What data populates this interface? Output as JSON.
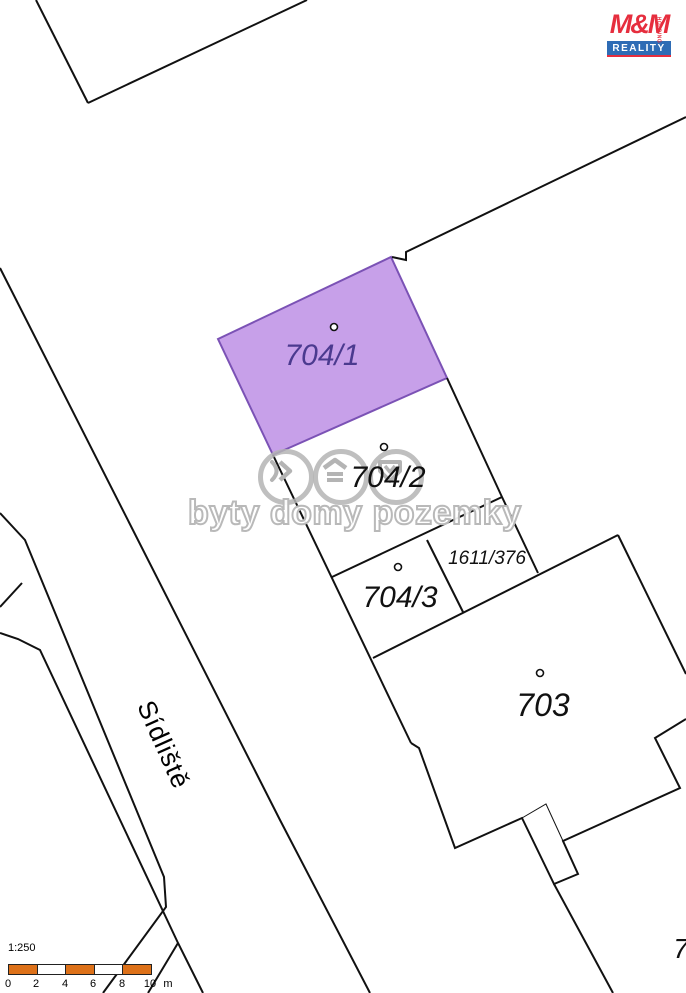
{
  "street": {
    "name": "Sídliště"
  },
  "logo": {
    "brand": "M&M",
    "sub": "REALITY",
    "side": "HOLDING"
  },
  "watermark": {
    "text": "byty domy pozemky",
    "icons": [
      "chevrons-icon",
      "roof-icon",
      "house-shield-icon"
    ]
  },
  "scale_bar": {
    "ratio": "1:250",
    "ticks": [
      "0",
      "2",
      "4",
      "6",
      "8",
      "10"
    ],
    "unit": "m"
  },
  "colors": {
    "line": "#111111",
    "highlight_fill": "#c7a0e9",
    "highlight_stroke": "#7b52b5",
    "highlight_label": "#4b3a8f",
    "watermark_gray": "#b9b9b9",
    "scale_orange": "#dd7119",
    "logo_red": "#e62e3e",
    "logo_blue": "#2e6cb5"
  },
  "map": {
    "width": 686,
    "height": 993,
    "highlight_parcel": {
      "name": "parcel-704-1",
      "label": "704/1",
      "points": [
        [
          218,
          339
        ],
        [
          391,
          257
        ],
        [
          447,
          378
        ],
        [
          273,
          455
        ]
      ]
    },
    "lines": [
      {
        "name": "nw-building-edge-left",
        "pts": [
          [
            36,
            0
          ],
          [
            88,
            103
          ]
        ]
      },
      {
        "name": "nw-building-edge-right",
        "pts": [
          [
            88,
            103
          ],
          [
            307,
            0
          ]
        ]
      },
      {
        "name": "ne-boundary-line",
        "pts": [
          [
            392,
            257
          ],
          [
            406,
            260
          ],
          [
            406,
            252
          ],
          [
            686,
            117
          ]
        ]
      },
      {
        "name": "street-east-edge",
        "pts": [
          [
            0,
            268
          ],
          [
            280,
            820
          ],
          [
            370,
            993
          ]
        ]
      },
      {
        "name": "street-west-edge",
        "pts": [
          [
            0,
            513
          ],
          [
            25,
            540
          ],
          [
            164,
            877
          ],
          [
            166,
            907
          ],
          [
            103,
            993
          ]
        ]
      },
      {
        "name": "sidewalk-edge",
        "pts": [
          [
            0,
            633
          ],
          [
            18,
            639
          ],
          [
            40,
            650
          ],
          [
            178,
            943
          ],
          [
            203,
            993
          ]
        ]
      },
      {
        "name": "sidewalk-spur",
        "pts": [
          [
            148,
            993
          ],
          [
            178,
            943
          ]
        ]
      },
      {
        "name": "west-edge-fragment",
        "pts": [
          [
            22,
            583
          ],
          [
            0,
            607
          ]
        ]
      },
      {
        "name": "parcel-street-boundary",
        "pts": [
          [
            273,
            455
          ],
          [
            411,
            743
          ]
        ]
      },
      {
        "name": "parcel-704-2-east-boundary",
        "pts": [
          [
            447,
            378
          ],
          [
            502,
            497
          ],
          [
            538,
            573
          ]
        ]
      },
      {
        "name": "parcel-704-2-704-3-boundary",
        "pts": [
          [
            502,
            497
          ],
          [
            332,
            577
          ]
        ]
      },
      {
        "name": "parcel-1611-376-west-boundary",
        "pts": [
          [
            427,
            540
          ],
          [
            463,
            612
          ]
        ]
      },
      {
        "name": "building-703-top-left-edge",
        "pts": [
          [
            373,
            658
          ],
          [
            618,
            535
          ]
        ]
      },
      {
        "name": "building-703-top-right-edge",
        "pts": [
          [
            618,
            535
          ],
          [
            686,
            674
          ]
        ]
      },
      {
        "name": "building-703-outline",
        "pts": [
          [
            686,
            719
          ],
          [
            655,
            738
          ],
          [
            680,
            788
          ],
          [
            563,
            841
          ],
          [
            578,
            874
          ],
          [
            554,
            884
          ],
          [
            522,
            818
          ],
          [
            455,
            848
          ],
          [
            419,
            748
          ],
          [
            411,
            743
          ]
        ]
      },
      {
        "name": "building-703-annex-thin-edge",
        "pts": [
          [
            522,
            818
          ],
          [
            546,
            804
          ],
          [
            563,
            841
          ]
        ],
        "w": 1
      },
      {
        "name": "south-parcel-boundary",
        "pts": [
          [
            554,
            884
          ],
          [
            613,
            993
          ]
        ]
      }
    ],
    "markers": [
      {
        "name": "parcel-point-704-1",
        "x": 334,
        "y": 327
      },
      {
        "name": "parcel-point-704-2",
        "x": 384,
        "y": 447
      },
      {
        "name": "parcel-point-704-3",
        "x": 398,
        "y": 567
      },
      {
        "name": "parcel-point-703",
        "x": 540,
        "y": 673
      }
    ],
    "labels": [
      {
        "name": "parcel-label-704-1",
        "text": "704/1",
        "x": 322,
        "y": 365,
        "size": 30,
        "color": "#4b3a8f"
      },
      {
        "name": "parcel-label-704-2",
        "text": "704/2",
        "x": 388,
        "y": 487,
        "size": 30,
        "color": "#111111"
      },
      {
        "name": "parcel-label-704-3",
        "text": "704/3",
        "x": 400,
        "y": 607,
        "size": 30,
        "color": "#111111"
      },
      {
        "name": "parcel-label-1611-376",
        "text": "1611/376",
        "x": 487,
        "y": 564,
        "size": 19,
        "color": "#111111"
      },
      {
        "name": "parcel-label-703",
        "text": "703",
        "x": 543,
        "y": 716,
        "size": 32,
        "color": "#111111"
      },
      {
        "name": "parcel-label-7",
        "text": "7",
        "x": 681,
        "y": 958,
        "size": 28,
        "color": "#111111"
      }
    ]
  }
}
